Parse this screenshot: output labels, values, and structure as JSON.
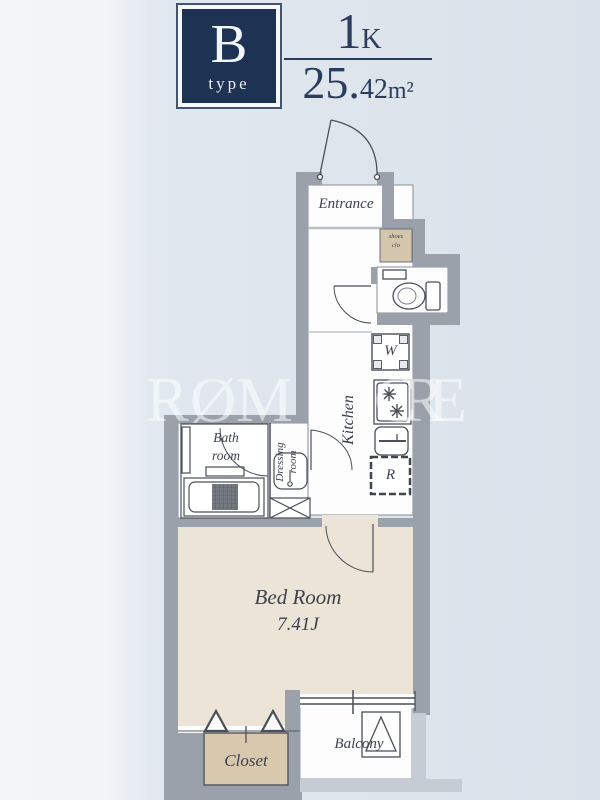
{
  "header": {
    "type_letter": "B",
    "type_word": "type",
    "layout_num": "1",
    "layout_suffix": "K",
    "area_main": "25.",
    "area_small": "42",
    "area_unit": "m²"
  },
  "watermark": {
    "l0": "R",
    "l1": "Ø",
    "l2": "M",
    "l3": "C",
    "l4": "R",
    "l5": "E"
  },
  "rooms": {
    "entrance": "Entrance",
    "shoes_top": "shoes",
    "shoes_bottom": "clo",
    "washer": "W",
    "kitchen": "Kitchen",
    "fridge": "R",
    "bath_top": "Bath",
    "bath_bottom": "room",
    "dressing_top": "Dressing",
    "dressing_bottom": "room",
    "bedroom_name": "Bed Room",
    "bedroom_size": "7.41J",
    "closet": "Closet",
    "balcony": "Balcony"
  },
  "colors": {
    "navy": "#1e3353",
    "wall_gray": "#9aa1ab",
    "wall_light": "#c6ccd5",
    "bedroom_floor": "#ece4d7",
    "closet_floor": "#d7c8ae",
    "background": "#dde4ec"
  }
}
